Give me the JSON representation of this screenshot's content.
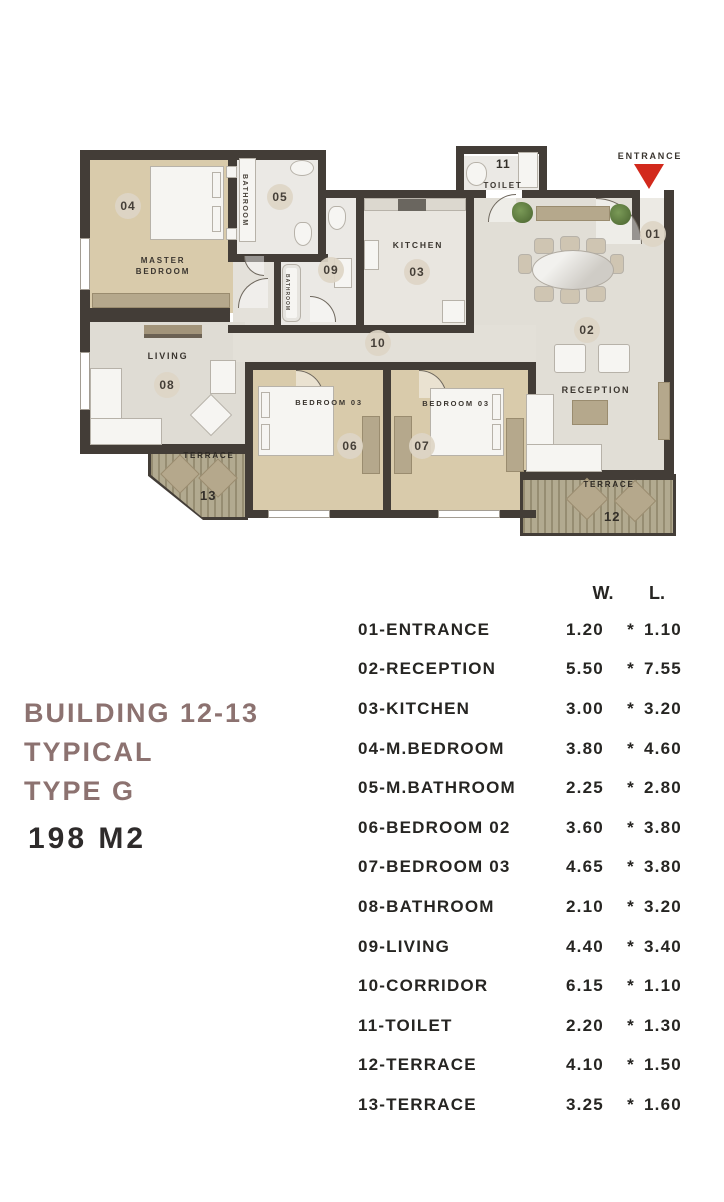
{
  "title_block": {
    "line1": "BUILDING 12-13",
    "line2": "TYPICAL",
    "line3": "TYPE G",
    "area": "198 M2"
  },
  "floor_plan": {
    "entrance_label": "ENTRANCE",
    "entrance_arrow_color": "#d2291c",
    "rooms": {
      "entrance": {
        "number": "01"
      },
      "reception": {
        "number": "02",
        "name": "RECEPTION"
      },
      "kitchen": {
        "number": "03",
        "name": "KITCHEN"
      },
      "master_bedroom": {
        "number": "04",
        "name": "MASTER\nBEDROOM"
      },
      "master_bathroom": {
        "number": "05",
        "name": "BATHROOM"
      },
      "bedroom_06": {
        "number": "06",
        "name": "BEDROOM 03"
      },
      "bedroom_07": {
        "number": "07",
        "name": "BEDROOM 03"
      },
      "living": {
        "number": "08",
        "name": "LIVING"
      },
      "bathroom_09": {
        "number": "09",
        "name": "BATHROOM"
      },
      "corridor": {
        "number": "10"
      },
      "toilet": {
        "number": "11",
        "name": "TOILET"
      },
      "terrace_12": {
        "number": "12",
        "name": "TERRACE"
      },
      "terrace_13": {
        "number": "13",
        "name": "TERRACE"
      }
    }
  },
  "dimensions_table": {
    "headers": {
      "w": "W.",
      "l": "L."
    },
    "separator": "*",
    "rows": [
      {
        "label": "01-ENTRANCE",
        "w": "1.20",
        "l": "1.10"
      },
      {
        "label": "02-RECEPTION",
        "w": "5.50",
        "l": "7.55"
      },
      {
        "label": "03-KITCHEN",
        "w": "3.00",
        "l": "3.20"
      },
      {
        "label": "04-M.BEDROOM",
        "w": "3.80",
        "l": "4.60"
      },
      {
        "label": "05-M.BATHROOM",
        "w": "2.25",
        "l": "2.80"
      },
      {
        "label": "06-BEDROOM 02",
        "w": "3.60",
        "l": "3.80"
      },
      {
        "label": "07-BEDROOM 03",
        "w": "4.65",
        "l": "3.80"
      },
      {
        "label": "08-BATHROOM",
        "w": "2.10",
        "l": "3.20"
      },
      {
        "label": "09-LIVING",
        "w": "4.40",
        "l": "3.40"
      },
      {
        "label": "10-CORRIDOR",
        "w": "6.15",
        "l": "1.10"
      },
      {
        "label": "11-TOILET",
        "w": "2.20",
        "l": "1.30"
      },
      {
        "label": "12-TERRACE",
        "w": "4.10",
        "l": "1.50"
      },
      {
        "label": "13-TERRACE",
        "w": "3.25",
        "l": "1.60"
      }
    ]
  },
  "colors": {
    "wall": "#433d37",
    "bedroom_floor": "#d9cbab",
    "living_floor": "#dfdcd4",
    "terrace_floor": "#b2aa90",
    "accent_red": "#d2291c",
    "title_text": "#8c7270",
    "table_text": "#262522"
  }
}
